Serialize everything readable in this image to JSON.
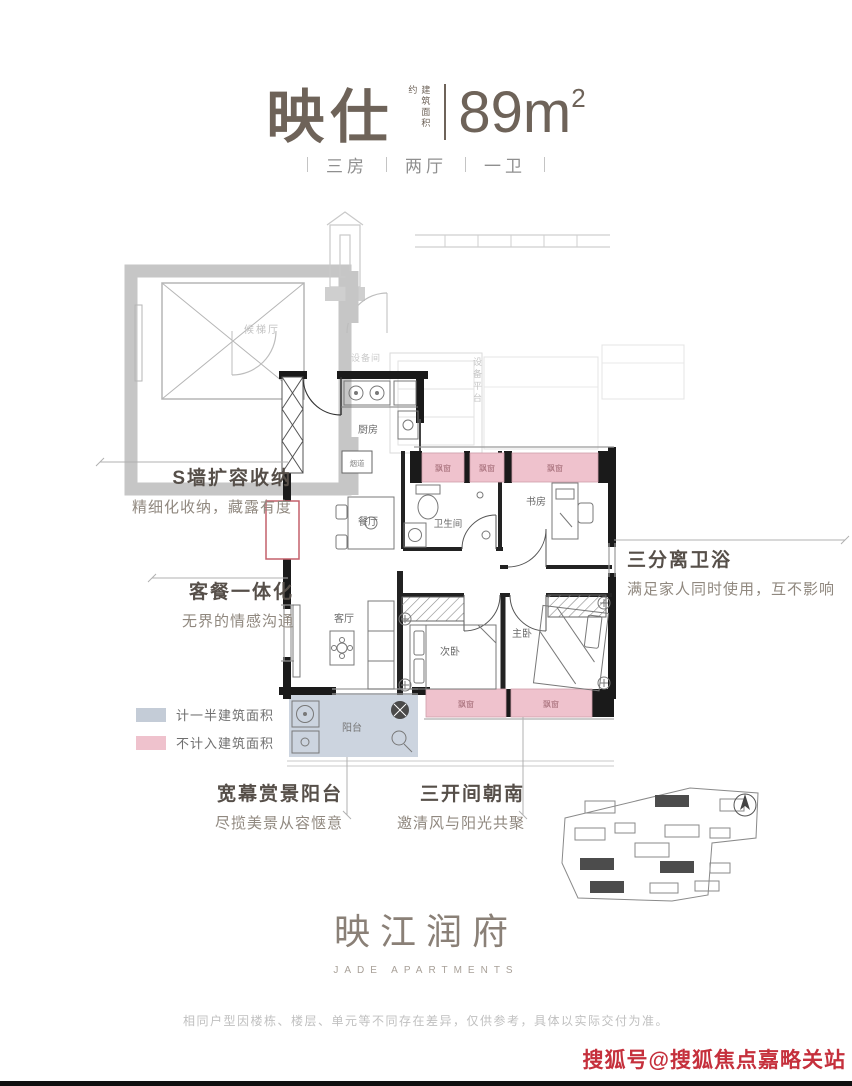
{
  "title": {
    "name": "映仕",
    "area_note": "建筑面积约",
    "area": "89m",
    "area_sup": "2",
    "specs": [
      "三房",
      "两厅",
      "一卫"
    ]
  },
  "plan": {
    "labels": {
      "lobby": "候梯厅",
      "equipment_room": "设备间",
      "equipment_platform": "设备平台",
      "kitchen": "厨房",
      "flue": "烟道",
      "dining": "餐厅",
      "bathroom": "卫生间",
      "study": "书房",
      "living": "客厅",
      "bedroom2": "次卧",
      "master": "主卧",
      "balcony": "阳台",
      "bay_window": "飘窗"
    }
  },
  "annotations": [
    {
      "title": "S墙扩容收纳",
      "desc": "精细化收纳，藏露有度"
    },
    {
      "title": "客餐一体化",
      "desc": "无界的情感沟通"
    },
    {
      "title": "三分离卫浴",
      "desc": "满足家人同时使用，互不影响"
    },
    {
      "title": "宽幕赏景阳台",
      "desc": "尽揽美景从容惬意"
    },
    {
      "title": "三开间朝南",
      "desc": "邀清风与阳光共聚"
    }
  ],
  "legend": [
    {
      "label": "计一半建筑面积",
      "color": "#c4ccd7"
    },
    {
      "label": "不计入建筑面积",
      "color": "#efc2cd"
    }
  ],
  "logo": {
    "cn": "映江润府",
    "en": "JADE APARTMENTS"
  },
  "footer": {
    "disclaimer": "相同户型因楼栋、楼层、单元等不同存在差异，仅供参考，具体以实际交付为准。"
  },
  "watermark": {
    "text": "搜狐号@搜狐焦点嘉略关站",
    "color": "#c5303c"
  },
  "colors": {
    "wall": "#1a1a1a",
    "bay_pink": "#efc2cd",
    "half_area_gray": "#c4ccd7",
    "balcony_fill": "#ccd4df",
    "title_brown": "#6e6359",
    "highlight_red": "#c4606b"
  }
}
